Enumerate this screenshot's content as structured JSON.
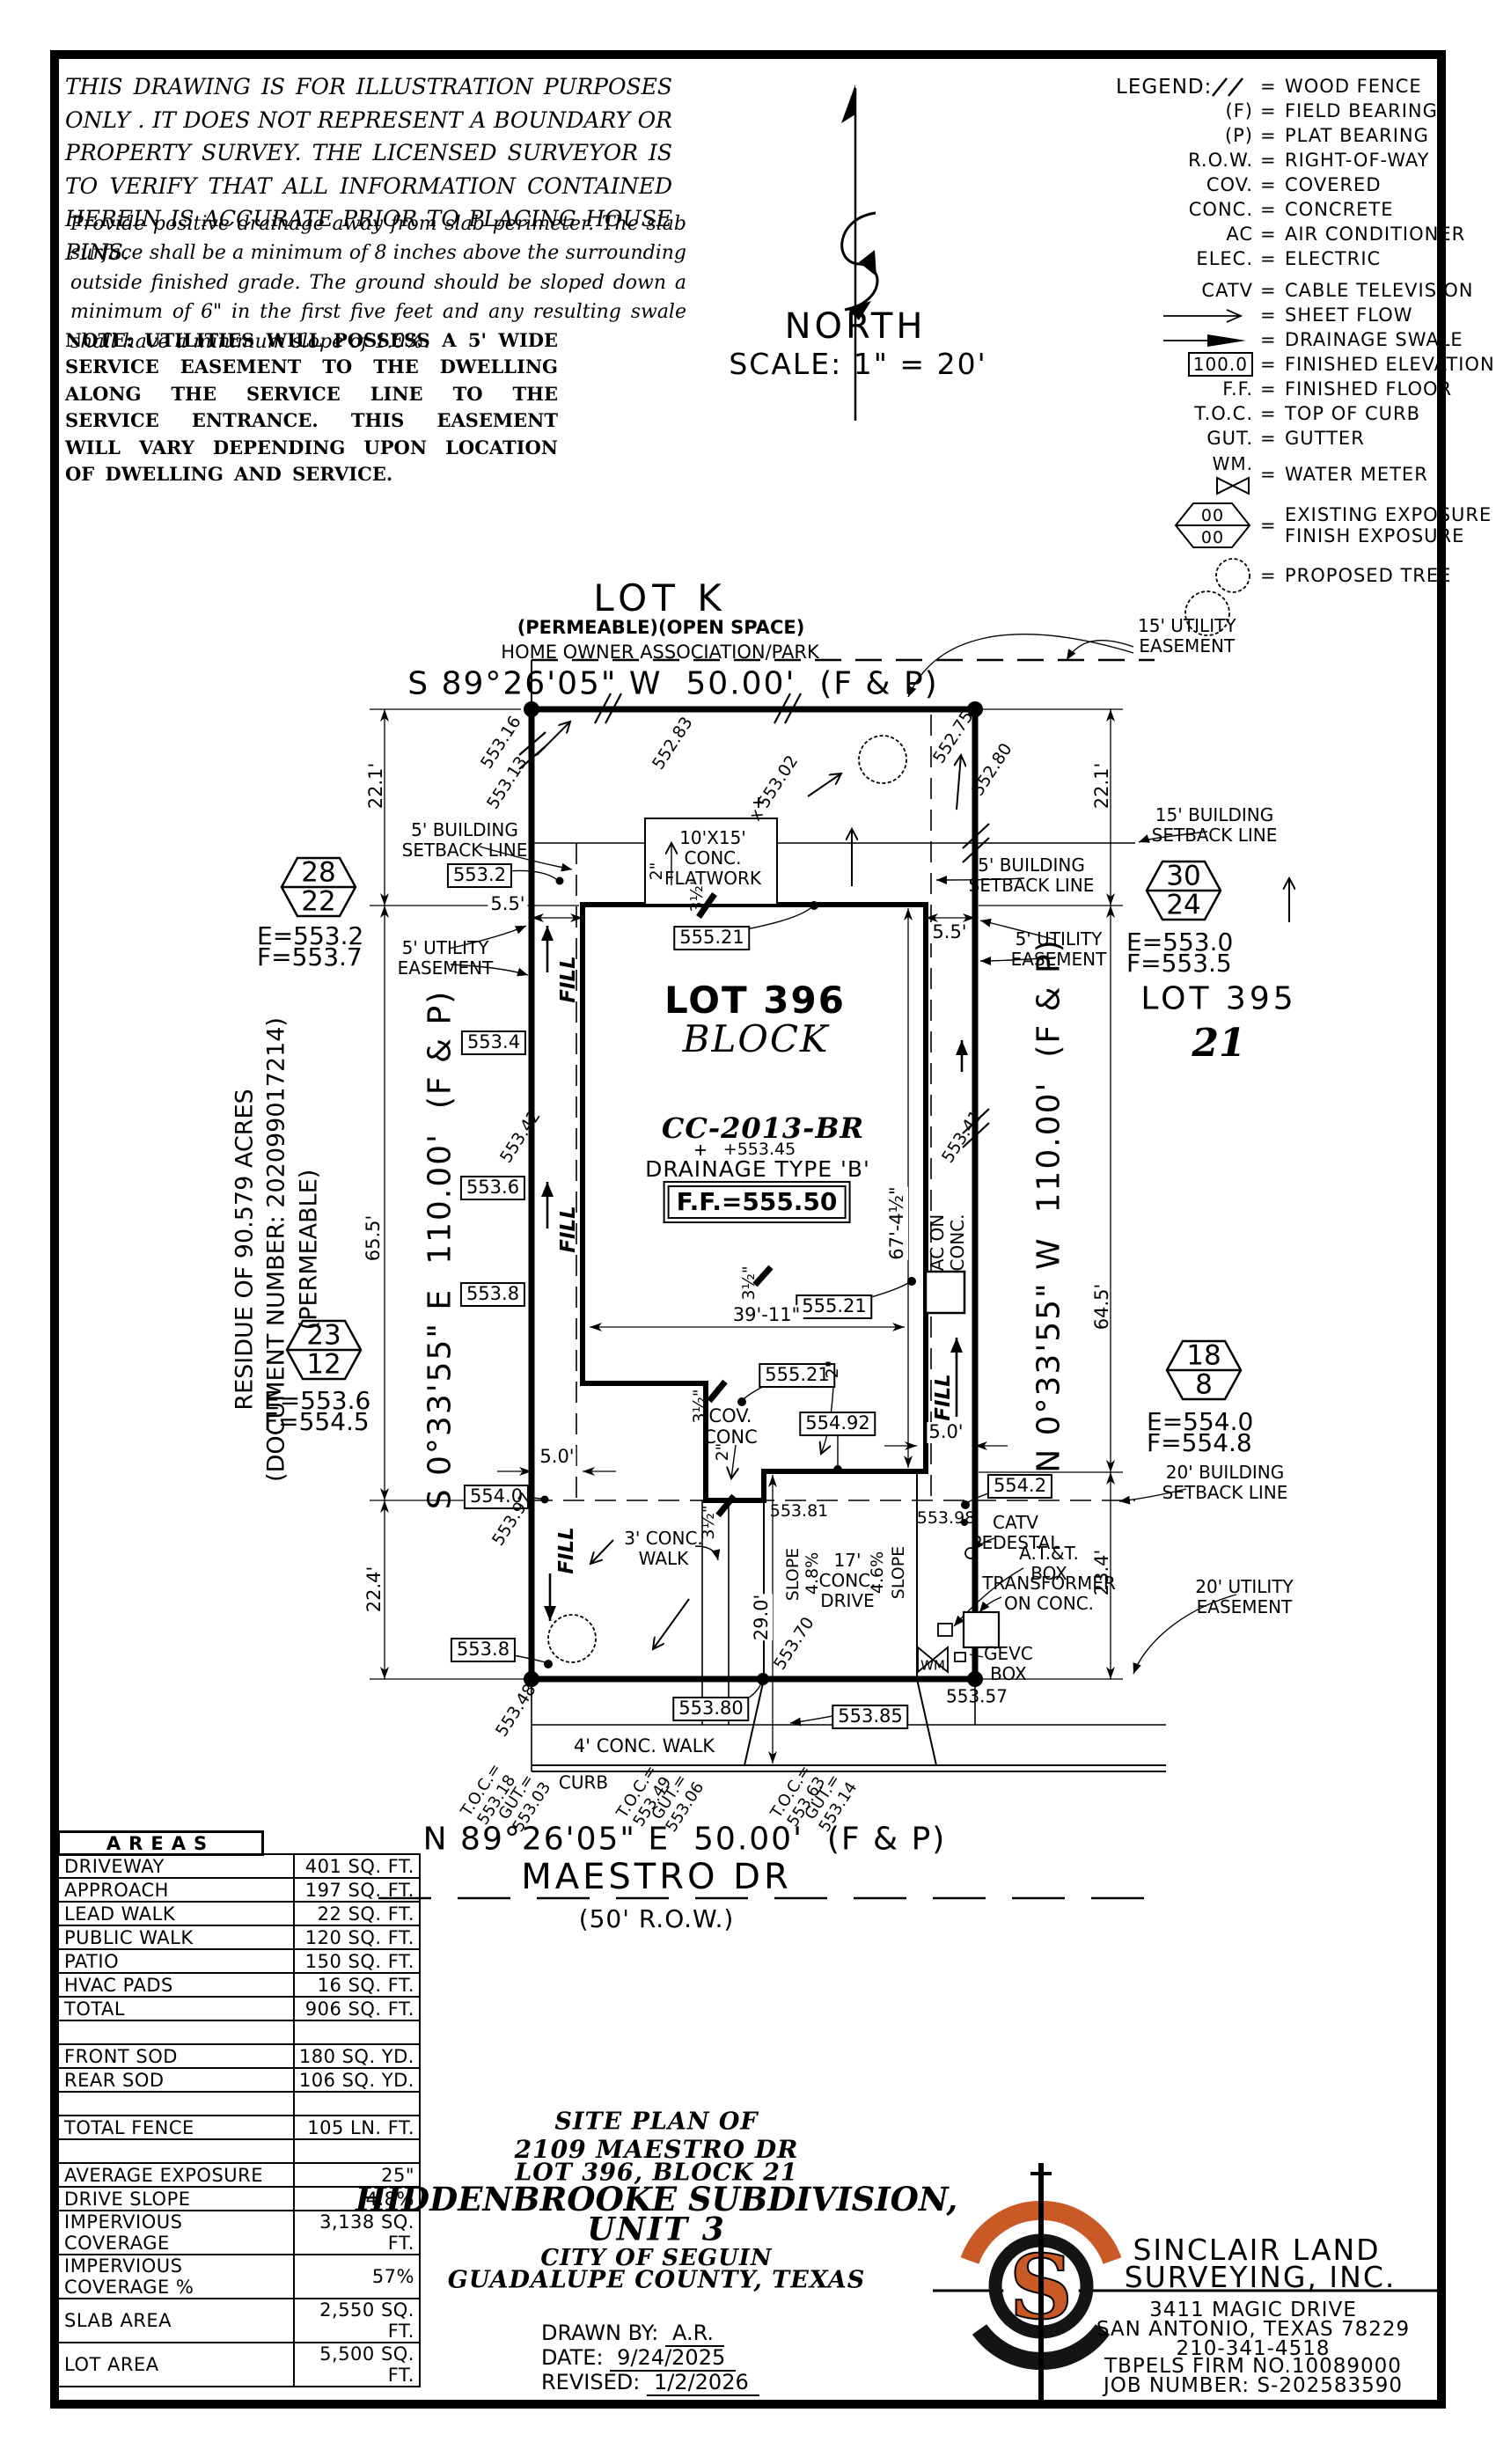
{
  "colors": {
    "accent": "#c95a26",
    "ink": "#000000"
  },
  "notes": {
    "disclaimer": "THIS DRAWING IS FOR ILLUSTRATION PURPOSES ONLY . IT DOES NOT REPRESENT A BOUNDARY OR PROPERTY SURVEY. THE LICENSED SURVEYOR IS TO VERIFY THAT ALL INFORMATION CONTAINED HEREIN IS ACCURATE PRIOR TO PLACING HOUSE PINS.",
    "drainage": "Provide positive drainage away from slab perimeter. The slab surface shall be a minimum of 8 inches above the surrounding outside finished grade. The ground should be sloped down a minimum of 6\" in the first five feet and any resulting swale shall have a minimum slope of 1.0%.",
    "utilities": "NOTE: UTILITIES WILL POSSESS A 5' WIDE SERVICE EASEMENT TO THE DWELLING ALONG THE SERVICE LINE TO THE SERVICE ENTRANCE. THIS EASEMENT WILL VARY DEPENDING UPON LOCATION OF DWELLING AND SERVICE."
  },
  "north": {
    "label": "NORTH",
    "scale": "SCALE: 1\" = 20'"
  },
  "legend": {
    "title": "LEGEND:",
    "eq": "=",
    "wood_fence": "WOOD FENCE",
    "f": "(F)",
    "field_bearing": "FIELD BEARING",
    "p": "(P)",
    "plat_bearing": "PLAT BEARING",
    "row_key": "R.O.W.",
    "row": "RIGHT-OF-WAY",
    "cov": "COV.",
    "covered": "COVERED",
    "conc": "CONC.",
    "concrete": "CONCRETE",
    "ac": "AC",
    "air_conditioner": "AIR CONDITIONER",
    "elec": "ELEC.",
    "electric": "ELECTRIC",
    "catv": "CATV",
    "cable": "CABLE TELEVISION",
    "sheet_flow": "SHEET FLOW",
    "swale": "DRAINAGE SWALE",
    "fin_elev_val": "100.0",
    "fin_elev": "FINISHED ELEVATION",
    "ff": "F.F.",
    "finished_floor": "FINISHED FLOOR",
    "toc": "T.O.C.",
    "top_of_curb": "TOP OF CURB",
    "gut": "GUT.",
    "gutter": "GUTTER",
    "wm": "WM.",
    "water_meter": "WATER METER",
    "exp_top": "00",
    "exp_bot": "00",
    "exposure": "EXISTING EXPOSURE\nFINISH EXPOSURE",
    "tree": "PROPOSED TREE"
  },
  "plan": {
    "lot_k": {
      "name": "LOT K",
      "sub1": "(PERMEABLE)(OPEN SPACE)",
      "sub2": "HOME OWNER ASSOCIATION/PARK"
    },
    "bearing_north": "S 89°26'05\" W  50.00'  (F & P)",
    "bearing_south": "N 89°26'05\" E  50.00'  (F & P)",
    "bearing_west": "S 0°33'55\" E  110.00'  (F & P)",
    "bearing_east": "N 0°33'55\" W  110.00'  (F & P)",
    "street": {
      "name": "MAESTRO DR",
      "row": "(50' R.O.W.)",
      "curb": "CURB"
    },
    "residue": "RESIDUE OF 90.579 ACRES\n(DOCUMENT NUMBER: 202099017214)\n(PERMEABLE)",
    "lot396": {
      "name": "LOT 396",
      "block": "BLOCK",
      "cc": "CC-2013-BR",
      "spot": "+553.45",
      "drainage": "DRAINAGE TYPE 'B'",
      "ff": "F.F.=555.50"
    },
    "lot395": {
      "name": "LOT 395",
      "block": "21"
    },
    "markers": {
      "m28": {
        "a": "28",
        "b": "22",
        "e": "E=553.2",
        "f": "F=553.7"
      },
      "m30": {
        "a": "30",
        "b": "24",
        "e": "E=553.0",
        "f": "F=553.5"
      },
      "m23": {
        "a": "23",
        "b": "12",
        "e": "E=553.6",
        "f": "F=554.5"
      },
      "m18": {
        "a": "18",
        "b": "8",
        "e": "E=554.0",
        "f": "F=554.8"
      }
    },
    "easements": {
      "ue15": "15' UTILITY\nEASEMENT",
      "bs15": "15' BUILDING\nSETBACK LINE",
      "bs5": "5' BUILDING\nSETBACK LINE",
      "ue5": "5' UTILITY\nEASEMENT",
      "bs20": "20' BUILDING\nSETBACK LINE",
      "ue20": "20' UTILITY\nEASEMENT"
    },
    "features": {
      "flatwork": "10'X15'\nCONC.\nFLATWORK",
      "cov_conc": "COV.\nCONC",
      "ac": "AC ON\nCONC.",
      "fill": "FILL",
      "slope": "SLOPE",
      "pct48": "4.8%",
      "pct46": "4.6%",
      "drive": "17'\nCONC.\nDRIVE",
      "walk3": "3' CONC.\nWALK",
      "walk4": "4' CONC. WALK",
      "catv": "CATV\nPEDESTAL",
      "att": "A.T.&T.\nBOX",
      "transformer": "TRANSFORMER\nON CONC.",
      "gevc": "GEVC\nBOX",
      "wm": "WM"
    },
    "dims": {
      "d221": "22.1'",
      "d655": "65.5'",
      "d224": "22.4'",
      "d645": "64.5'",
      "d234": "23.4'",
      "d55": "5.5'",
      "d50": "5.0'",
      "d290": "29.0'",
      "d3911": "39'-11\"",
      "d674": "67'-4½\"",
      "d2": "2\"",
      "d35": "3½\""
    },
    "spots": {
      "b5532": "553.2",
      "b5534": "553.4",
      "b5536": "553.6",
      "b5538": "553.8",
      "b5540": "554.0",
      "b55521": "555.21",
      "b55492": "554.92",
      "b5542": "554.2",
      "b55380": "553.80",
      "b55385": "553.85",
      "s55316": "553.16",
      "s55313": "553.13",
      "s55283": "552.83",
      "s55275": "552.75",
      "s55280": "552.80",
      "s55302": "x 553.02",
      "s55342": "553.42",
      "s55341": "553.41",
      "s55348": "553.48",
      "s55397": "553.97",
      "s55398": "553.98",
      "s55381": "553.81",
      "s55357": "553.57",
      "s55370": "553.70"
    },
    "toc": {
      "l1": "T.O.C.=\n553.18",
      "l2": "GUT.=\n553.03",
      "c1": "T.O.C.=\n553.49",
      "c2": "GUT.=\n553.06",
      "r1": "T.O.C.=\n553.63",
      "r2": "GUT.=\n553.14"
    }
  },
  "areas_table": {
    "title": "AREAS",
    "rows": [
      {
        "label": "DRIVEWAY",
        "value": "401 SQ. FT."
      },
      {
        "label": "APPROACH",
        "value": "197 SQ. FT."
      },
      {
        "label": "LEAD WALK",
        "value": "22 SQ. FT."
      },
      {
        "label": "PUBLIC WALK",
        "value": "120 SQ. FT."
      },
      {
        "label": "PATIO",
        "value": "150 SQ. FT."
      },
      {
        "label": "HVAC PADS",
        "value": "16 SQ. FT."
      },
      {
        "label": "TOTAL",
        "value": "906 SQ. FT."
      },
      {
        "label": "",
        "value": ""
      },
      {
        "label": "FRONT SOD",
        "value": "180 SQ. YD."
      },
      {
        "label": "REAR SOD",
        "value": "106 SQ. YD."
      },
      {
        "label": "",
        "value": ""
      },
      {
        "label": "TOTAL FENCE",
        "value": "105 LN. FT."
      },
      {
        "label": "",
        "value": ""
      },
      {
        "label": "AVERAGE EXPOSURE",
        "value": "25\""
      },
      {
        "label": "DRIVE SLOPE",
        "value": "4.8%"
      },
      {
        "label": "IMPERVIOUS COVERAGE",
        "value": "3,138 SQ. FT."
      },
      {
        "label": "IMPERVIOUS COVERAGE %",
        "value": "57%"
      },
      {
        "label": "SLAB AREA",
        "value": "2,550 SQ. FT."
      },
      {
        "label": "LOT AREA",
        "value": "5,500 SQ. FT."
      }
    ]
  },
  "title_block": {
    "l1": "SITE PLAN OF",
    "l2": "2109 MAESTRO DR",
    "l3": "LOT 396, BLOCK 21",
    "l4": "HIDDENBROOKE SUBDIVISION,",
    "l5": "UNIT 3",
    "l6": "CITY OF SEGUIN",
    "l7": "GUADALUPE COUNTY, TEXAS",
    "drawn_by_label": "DRAWN BY:",
    "drawn_by": "A.R.",
    "date_label": "DATE:",
    "date": "9/24/2025",
    "revised_label": "REVISED:",
    "revised": "1/2/2026"
  },
  "company": {
    "name1": "SINCLAIR LAND",
    "name2": "SURVEYING, INC.",
    "addr1": "3411 MAGIC DRIVE",
    "addr2": "SAN ANTONIO, TEXAS 78229",
    "phone": "210-341-4518",
    "firm": "TBPELS FIRM NO.10089000",
    "job": "JOB NUMBER: S-202583590",
    "logo_s": "S"
  }
}
